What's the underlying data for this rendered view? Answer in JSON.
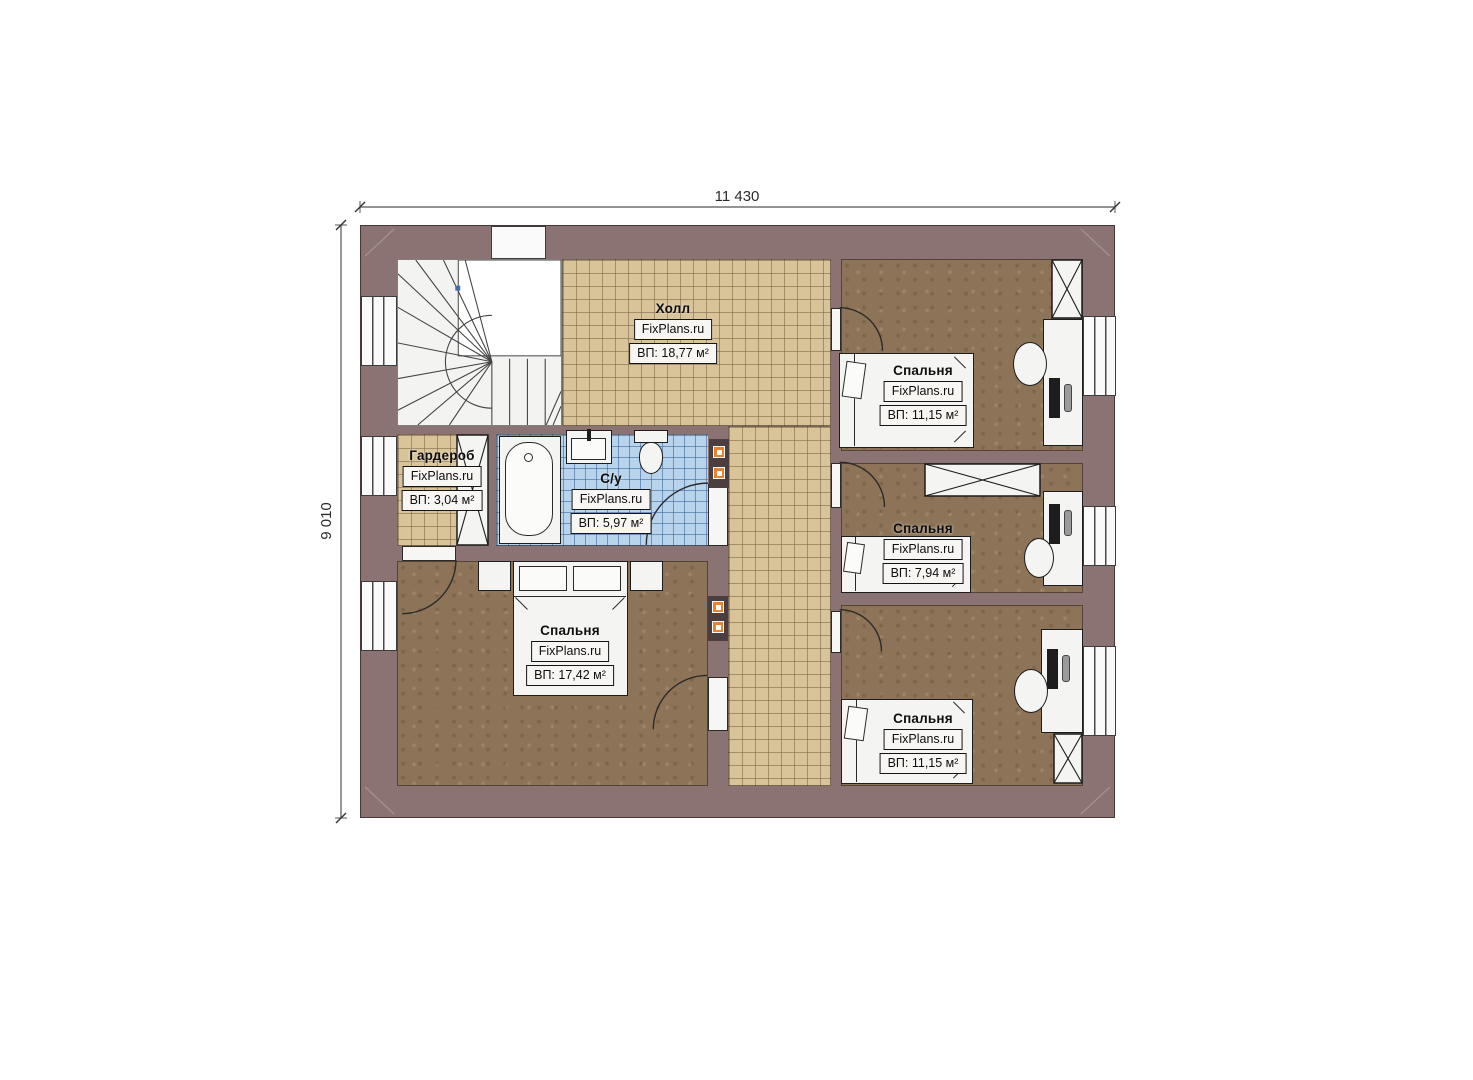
{
  "plan_title": "Floor plan",
  "dimensions": {
    "width_label": "11 430",
    "height_label": "9 010"
  },
  "watermark": "FixPlans.ru",
  "rooms": {
    "hall": {
      "name": "Холл",
      "area": "ВП: 18,77 м²"
    },
    "wardrobe": {
      "name": "Гардероб",
      "area": "ВП: 3,04 м²"
    },
    "bathroom": {
      "name": "С/у",
      "area": "ВП: 5,97 м²"
    },
    "bedroom_master": {
      "name": "Спальня",
      "area": "ВП: 17,42 м²"
    },
    "bedroom_top": {
      "name": "Спальня",
      "area": "ВП: 11,15 м²"
    },
    "bedroom_mid": {
      "name": "Спальня",
      "area": "ВП: 7,94 м²"
    },
    "bedroom_bottom": {
      "name": "Спальня",
      "area": "ВП: 11,15 м²"
    }
  },
  "colors": {
    "wall": "#8b7373",
    "tile_tan": "#d9c399",
    "tile_blue": "#b8d3ec",
    "carpet": "#8d7458",
    "accent_vent": "#e8822e"
  }
}
